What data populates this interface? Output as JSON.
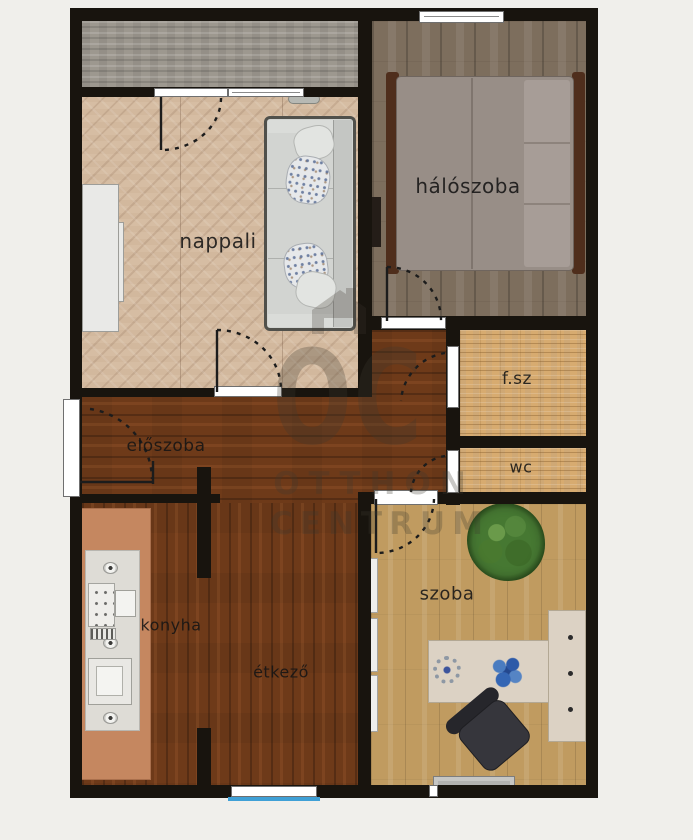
{
  "floorplan": {
    "background_color": "#f0efeb",
    "wall_color": "#18140e",
    "window_glass_color": "#3fa0d6",
    "rooms": [
      {
        "id": "nappali",
        "label": "nappali"
      },
      {
        "id": "haloszoba",
        "label": "hálószoba"
      },
      {
        "id": "furdoszoba",
        "label": "f.sz"
      },
      {
        "id": "wc",
        "label": "wc"
      },
      {
        "id": "eloszoba",
        "label": "előszoba"
      },
      {
        "id": "konyha",
        "label": "konyha"
      },
      {
        "id": "etkezo",
        "label": "étkező"
      },
      {
        "id": "szoba",
        "label": "szoba"
      }
    ],
    "watermark": {
      "logo_text": "OC",
      "line1": "OTTHON",
      "line2": "CENTRUM"
    }
  }
}
